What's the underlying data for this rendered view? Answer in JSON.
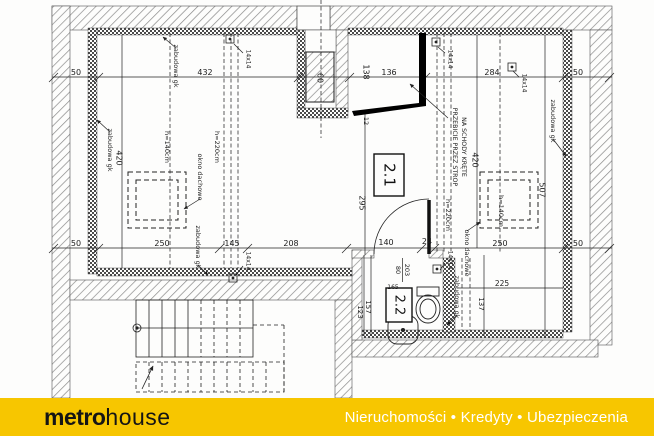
{
  "plan": {
    "line_color": "#2a2a2a",
    "dims": {
      "top": [
        "50",
        "432",
        "60",
        "138",
        "136",
        "284",
        "50"
      ],
      "bottom": [
        "50",
        "250",
        "145",
        "208",
        "140",
        "24",
        "250",
        "50"
      ],
      "v_left_420": "420",
      "v_right_420": "420",
      "v_507": "507",
      "v_295": "295",
      "v_12": "12",
      "bath_225": "225",
      "bath_137": "137",
      "bath_157": "157",
      "bath_123": "123",
      "bath_165": "165",
      "door_80": "80",
      "door_203": "203"
    },
    "heights": {
      "h140": "h=140cm",
      "h220": "h=220cm"
    },
    "vent": "14x14",
    "notes": {
      "zabudowa": "zabudowa gk",
      "okno": "okno dachowe",
      "przebicie1": "PRZEBICIE PRZEZ STROP",
      "przebicie2": "NA SCHODY KRĘTE"
    },
    "rooms": {
      "upper": "2.1",
      "bath": "2.2"
    }
  },
  "footer": {
    "brand_bold": "metro",
    "brand_light": "house",
    "tagline": "Nieruchomości • Kredyty • Ubezpieczenia",
    "bg_color": "#F7C600",
    "brand_color": "#151515",
    "tagline_color": "#FFFFFF"
  }
}
